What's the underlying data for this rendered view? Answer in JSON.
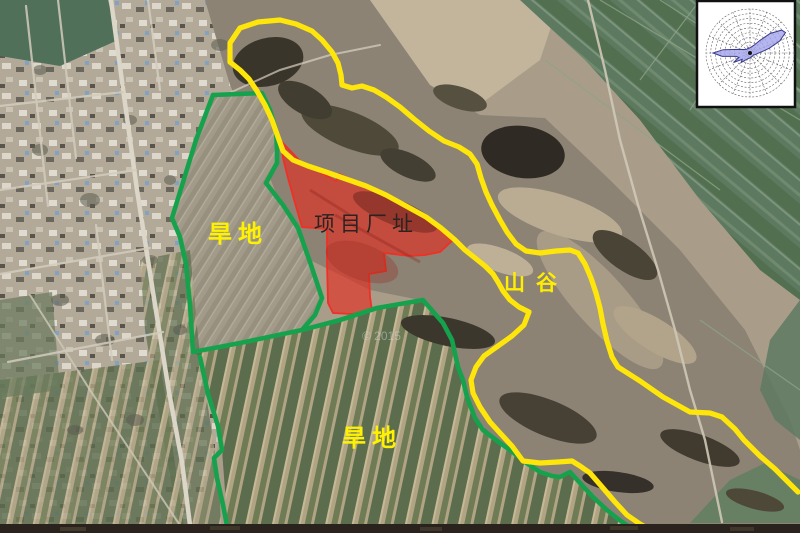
{
  "map": {
    "type": "satellite-annotation-map",
    "labels": {
      "project_site": "项目厂址",
      "dry_land_upper": "旱地",
      "dry_land_lower": "旱地",
      "valley": "山谷"
    },
    "watermark": "© 2015",
    "colors": {
      "project_site_fill": "#E62A1E",
      "project_site_stroke": "#F03024",
      "boundary_green": "#16A24C",
      "boundary_yellow": "#FFE60A",
      "label_yellow": "#FFF200",
      "project_label_color": "#2B2320"
    },
    "wind_rose": {
      "type": "polar-rose",
      "rings": 9,
      "spokes": 16,
      "petal_fill": "#A3A3EC",
      "petal_stroke": "#3B3B8C",
      "dominant_directions": [
        {
          "dir": "NE",
          "radius": 41
        },
        {
          "dir": "W",
          "radius": 37
        },
        {
          "dir": "WSW",
          "radius": 19
        },
        {
          "dir": "SW",
          "radius": 13
        }
      ]
    }
  }
}
